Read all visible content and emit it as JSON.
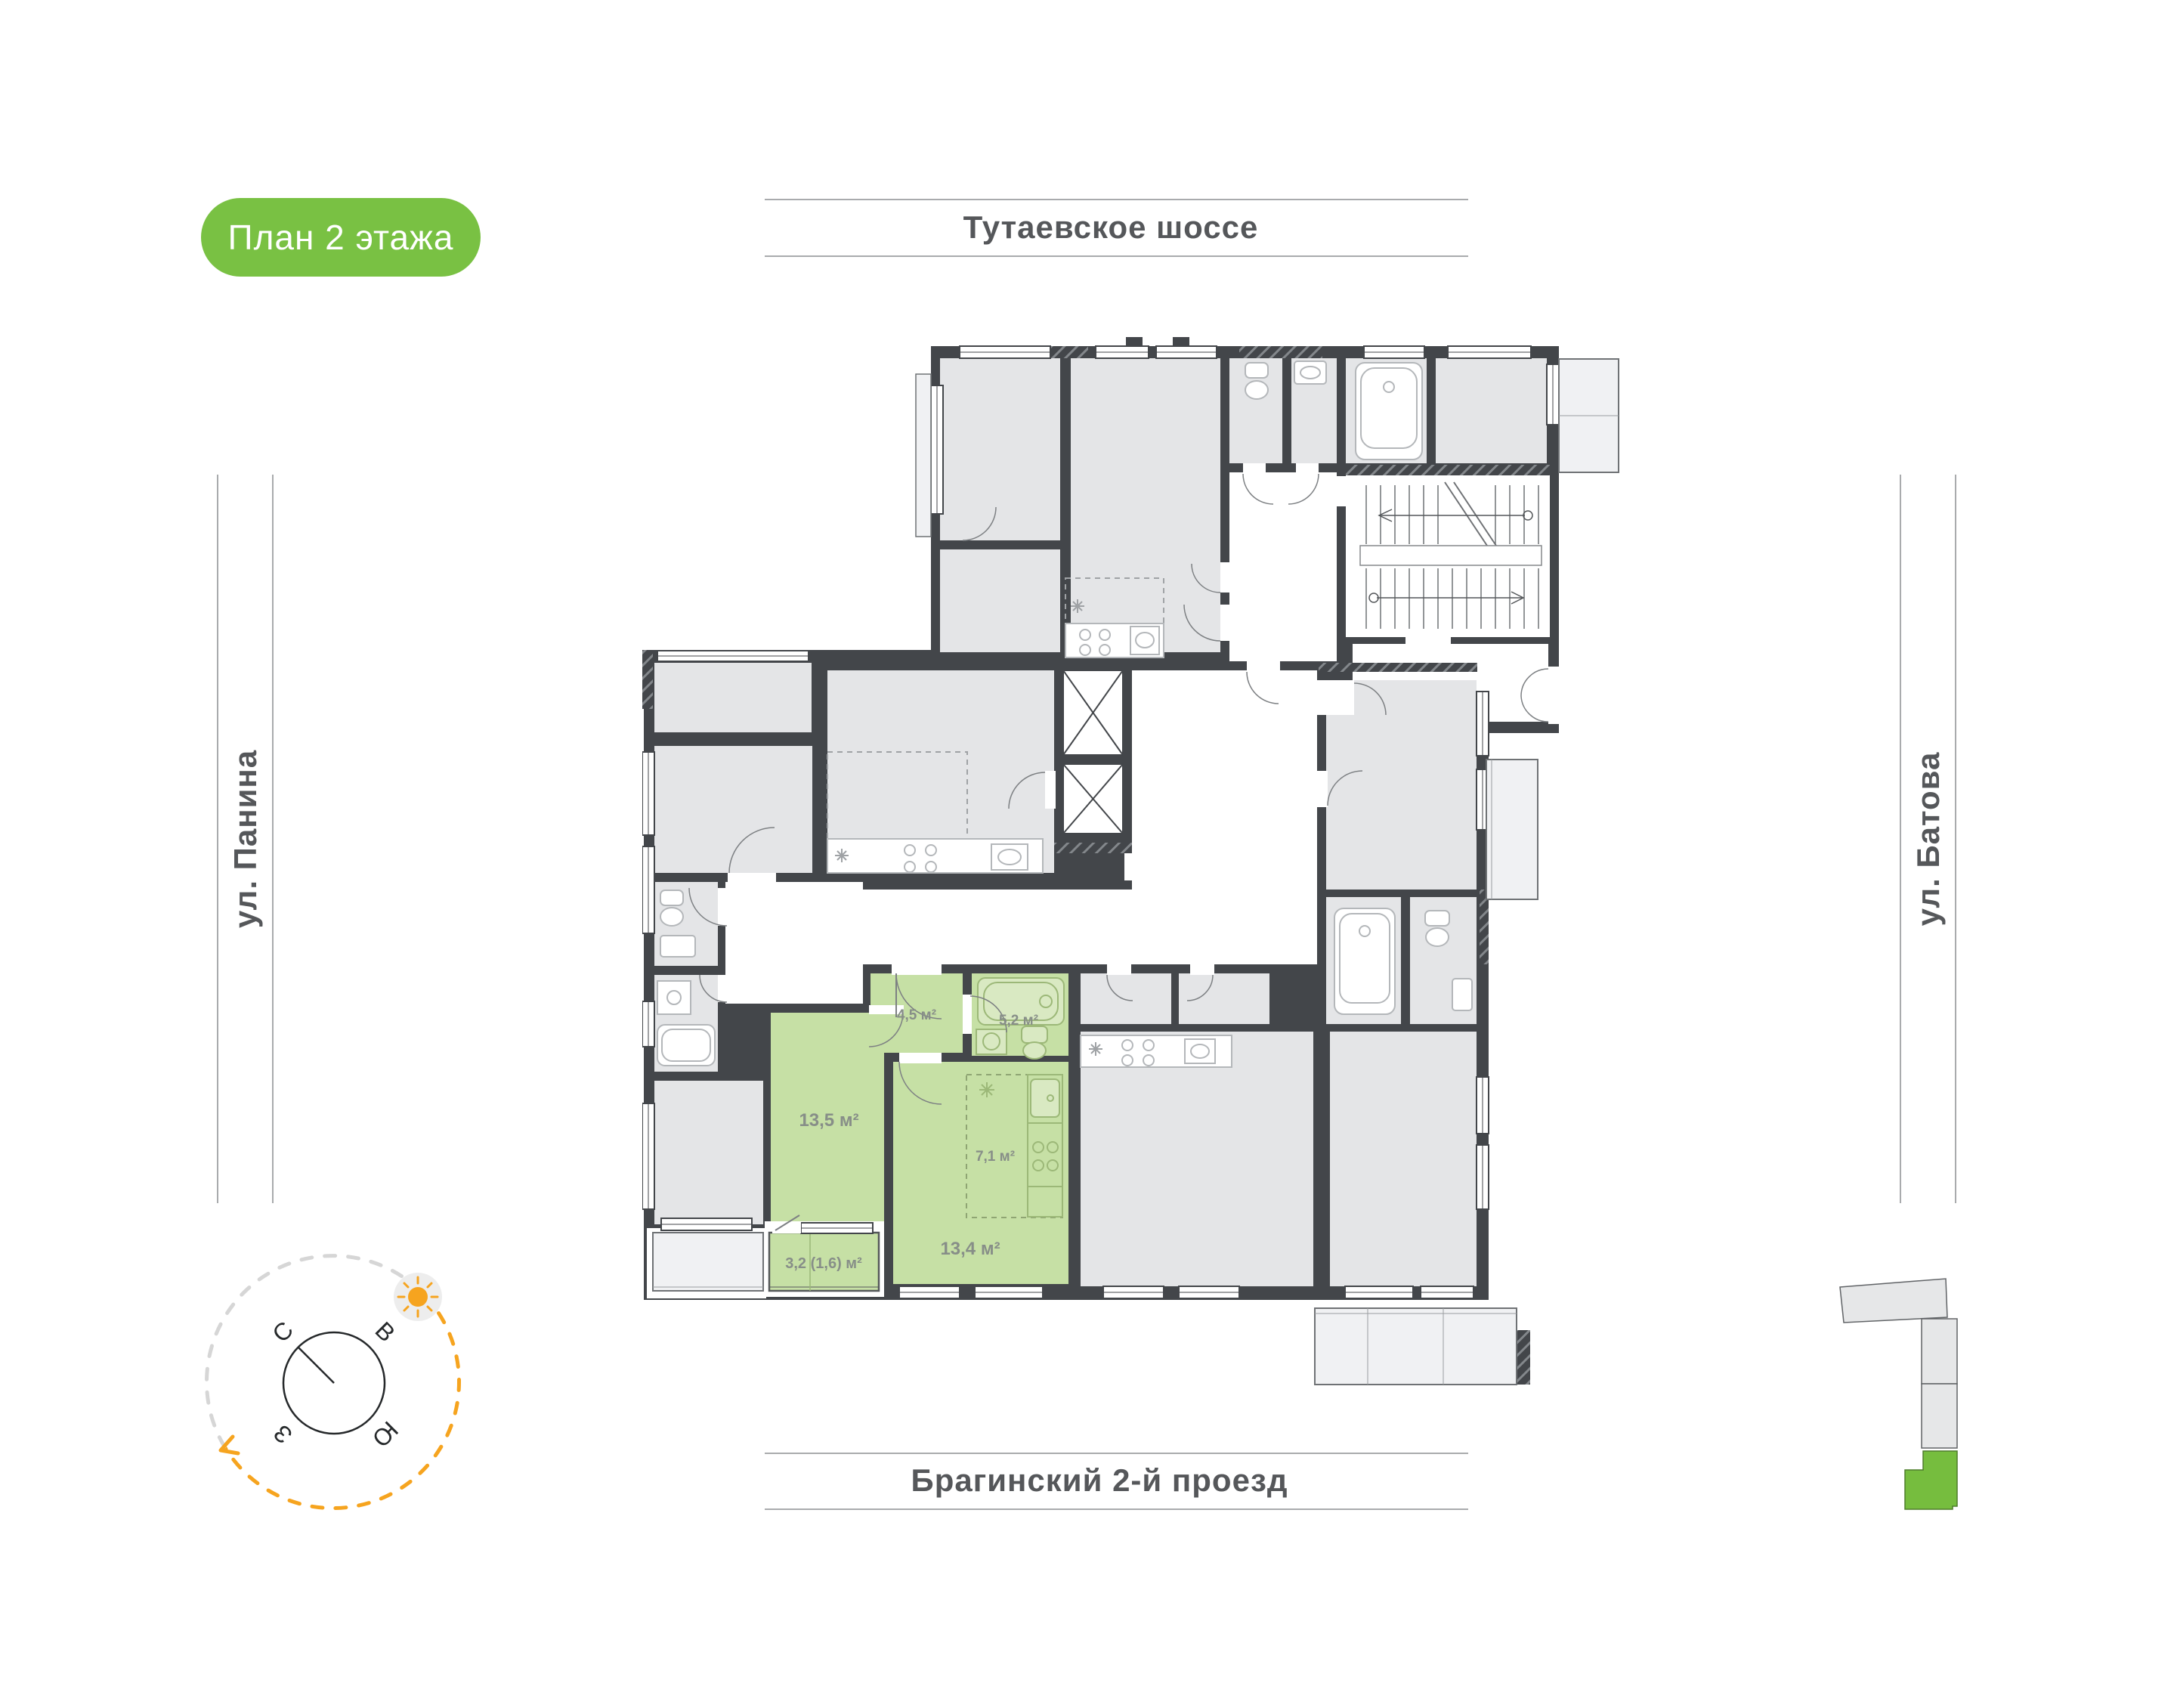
{
  "badge": {
    "label": "План 2 этажа"
  },
  "streets": {
    "top": "Тутаевское шоссе",
    "bottom": "Брагинский 2-й проезд",
    "left": "ул. Панина",
    "right": "ул. Батова"
  },
  "apartment": {
    "highlighted": true,
    "rooms": [
      {
        "name": "hallway",
        "area": "4,5 м²"
      },
      {
        "name": "bathroom",
        "area": "5,2 м²"
      },
      {
        "name": "kitchen",
        "area": "7,1 м²"
      },
      {
        "name": "bedroom",
        "area": "13,5 м²"
      },
      {
        "name": "living-room",
        "area": "13,4 м²"
      },
      {
        "name": "balcony",
        "area": "3,2 (1,6) м²"
      }
    ]
  },
  "compass": {
    "north": "С",
    "east": "В",
    "south": "Ю",
    "west": "З"
  },
  "icons": [
    "sun-icon",
    "compass-rose-icon",
    "stairs-icon",
    "elevator-icon"
  ],
  "colors": {
    "badge_green": "#79c143",
    "apartment_green": "#c6e0a5",
    "minimap_green": "#76bd3e",
    "wall_dark": "#43464a",
    "room_gray": "#e4e5e7",
    "street_text": "#55575a",
    "compass_orange": "#f6a41f",
    "label_gray": "#878e88"
  }
}
